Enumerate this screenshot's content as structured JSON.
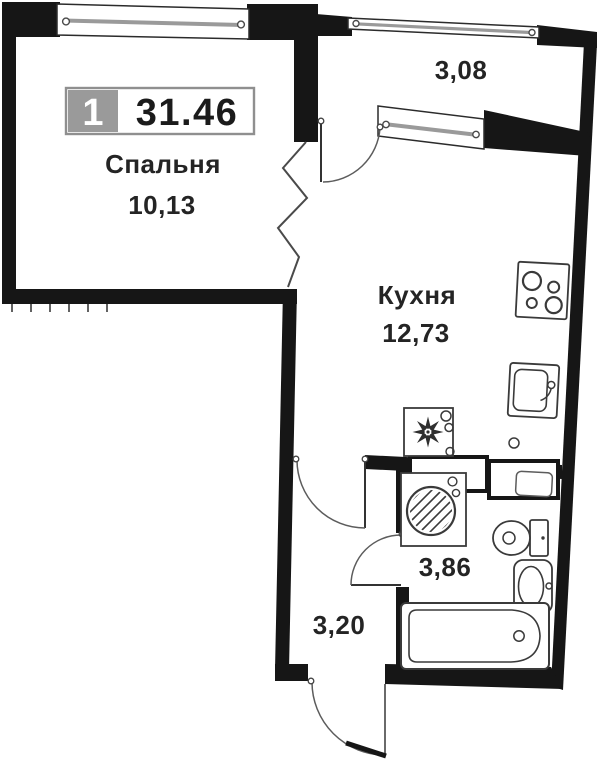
{
  "floor_plan": {
    "unit_badge": {
      "rooms": "1",
      "total_area": "31.46"
    },
    "rooms": {
      "bedroom": {
        "name": "Спальня",
        "area": "10,13"
      },
      "kitchen": {
        "name": "Кухня",
        "area": "12,73"
      },
      "balcony": {
        "area": "3,08"
      },
      "bathroom": {
        "area": "3,86"
      },
      "hallway": {
        "area": "3,20"
      }
    },
    "colors": {
      "wall": "#161616",
      "fixture_line": "#3a3a3a",
      "door_line": "#5c5c5c",
      "badge_gray": "#9a9a9a",
      "badge_border": "#8f8f8f",
      "text": "#242424",
      "background": "#ffffff"
    },
    "icons": [
      "window-icon",
      "balcony-glazing-icon",
      "door-arc-icon",
      "zigzag-break-icon",
      "stove-icon",
      "kitchen-sink-icon",
      "fridge-snowflake-icon",
      "washing-machine-icon",
      "vent-shaft-icon",
      "toilet-icon",
      "washbasin-icon",
      "bathtub-icon"
    ]
  }
}
